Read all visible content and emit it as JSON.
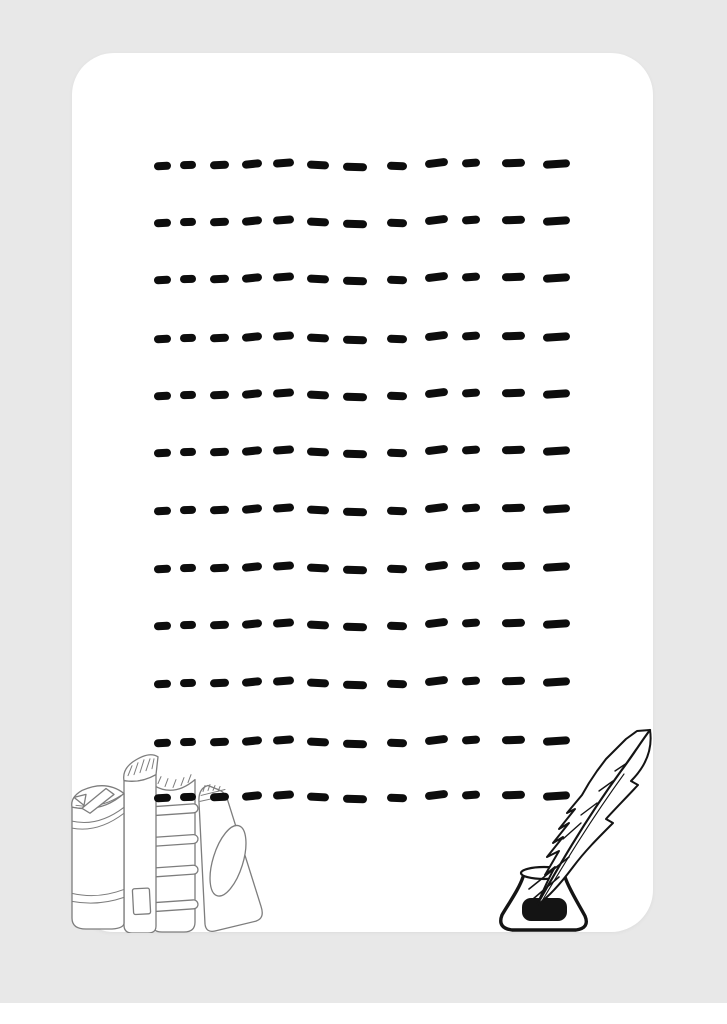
{
  "page": {
    "type": "printable-writing-sheet",
    "visible_text": ""
  },
  "colors": {
    "page_background": "#e8e8e8",
    "bottom_strip": "#ffffff",
    "sheet": "#ffffff",
    "dash": "#0d0d0d",
    "book_outline": "#7d7d7d",
    "quill_ink": "#141414"
  },
  "writing_sheet": {
    "rows": 12,
    "dashes_per_row": 12,
    "row_y": [
      165,
      222,
      279,
      338,
      395,
      452,
      510,
      568,
      625,
      683,
      742,
      797
    ],
    "dash_x": [
      154,
      180,
      210,
      242,
      273,
      307,
      343,
      387,
      425,
      462,
      502,
      543
    ],
    "dash_w": [
      17,
      16,
      19,
      20,
      21,
      22,
      24,
      20,
      23,
      18,
      23,
      27
    ],
    "dash_tilt": [
      -3,
      -2,
      -3,
      -6,
      -4,
      3,
      2,
      2,
      -7,
      -4,
      -2,
      -4
    ],
    "dash_dy": [
      1,
      0,
      0,
      -1,
      -2,
      0,
      2,
      1,
      -2,
      -2,
      -2,
      -1
    ],
    "dash_height": 8
  },
  "illustrations": {
    "bottom_left": {
      "name": "books-stack",
      "description": "four standing books, line art"
    },
    "bottom_right": {
      "name": "quill-inkwell",
      "description": "feather quill standing in an ink bottle, line art"
    }
  }
}
